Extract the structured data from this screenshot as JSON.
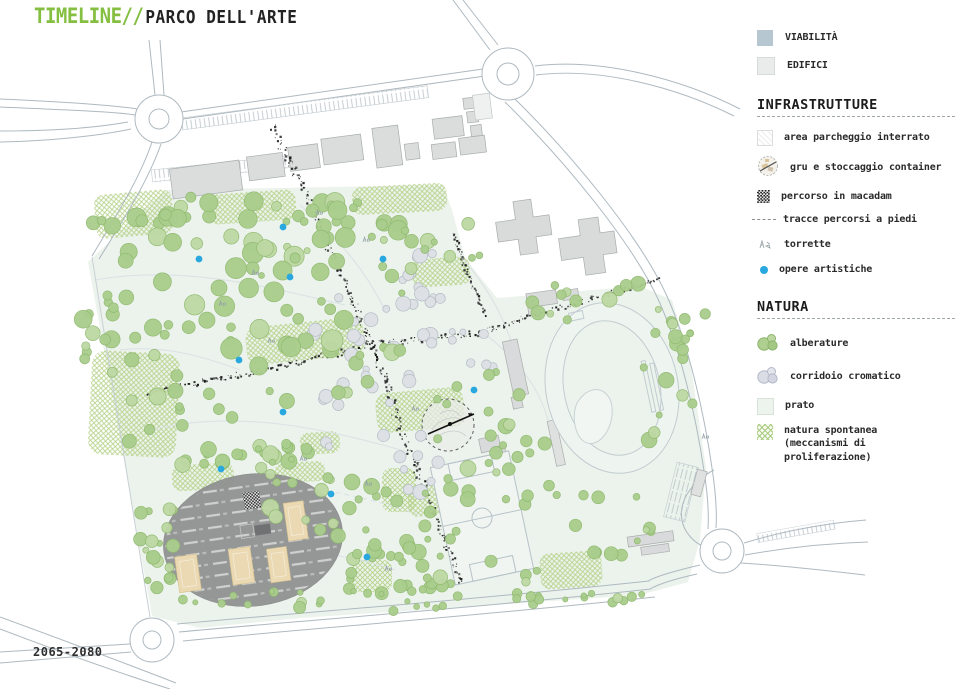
{
  "title": {
    "brand": "TIMELINE//",
    "subtitle": "PARCO DELL'ARTE"
  },
  "footer": {
    "years": "2065-2080"
  },
  "colors": {
    "accent_green": "#84bf41",
    "viability": "#b7c7d2",
    "buildings": "#e9eceb",
    "lawn": "#edf3ed",
    "artworks_blue": "#29a8e0",
    "tree_green": "#a9cd8c",
    "macadam_black": "#1b1b1b",
    "container_tan": "#e9d8b2"
  },
  "legend": {
    "viability_label": "VIABILITÀ",
    "buildings_label": "EDIFICI",
    "sections": [
      {
        "title": "INFRASTRUTTURE",
        "items": [
          {
            "label": "area parcheggio interrato",
            "icon": "underground-parking-swatch"
          },
          {
            "label": "gru e stoccaggio container",
            "icon": "crane-container-icon"
          },
          {
            "label": "percorso in macadam",
            "icon": "macadam-swatch"
          },
          {
            "label": "tracce percorsi a piedi",
            "icon": "footpath-dash-icon"
          },
          {
            "label": "torrette",
            "icon": "tower-icon"
          },
          {
            "label": "opere artistiche",
            "icon": "artwork-dot-icon"
          }
        ]
      },
      {
        "title": "NATURA",
        "items": [
          {
            "label": "alberature",
            "icon": "trees-icon"
          },
          {
            "label": "corridoio cromatico",
            "icon": "chromatic-corridor-icon"
          },
          {
            "label": "prato",
            "icon": "lawn-swatch"
          },
          {
            "label": "natura spontanea\n(meccanismi di proliferazione)",
            "icon": "spontaneous-nature-swatch"
          }
        ]
      }
    ]
  }
}
